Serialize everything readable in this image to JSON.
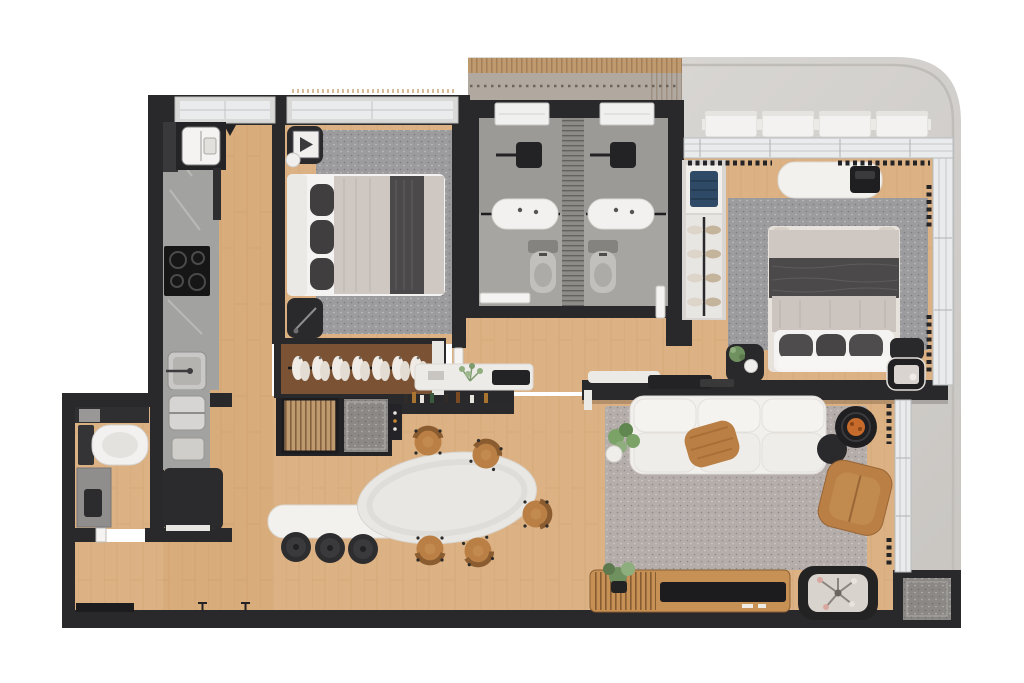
{
  "meta": {
    "kind": "apartment-floor-plan-render",
    "width": 1024,
    "height": 683,
    "visible_text": "none"
  },
  "colors": {
    "background": "#ffffff",
    "wall": "#29282a",
    "wood": "#dcb183",
    "terrace_light": "#dbd9d6",
    "terrace_dark": "#cbc8c4",
    "texture_zone": "#b1a9a0",
    "deck_band": "#c09a6f",
    "bath_floor": "#a7a5a2",
    "bath_floor_dark": "#9c9a97",
    "duct": "#8e8c89",
    "counter": "#a2a2a0",
    "counter_dark": "#39383a",
    "cooktop_black": "#161617",
    "fridge": "#2b2a2c",
    "white_furniture": "#f2f1ee",
    "off_white": "#e9e7e3",
    "rug_gray": "#9c9b9d",
    "rug_living": "#b4adaa",
    "duvet_dark": "#4b494a",
    "duvet_light": "#cfc8c2",
    "pillow_dark": "#403e3f",
    "caramel": "#b97f45",
    "caramel_dark": "#8a5c30",
    "plant_green": "#6f9160",
    "plant_green_light": "#8fae7e",
    "denim_blue": "#2e4a66",
    "mat_gray": "#8b8885",
    "glazing": "#e9ebec",
    "glazing_frame": "#b9bcbe",
    "closet_wood": "#7b5233",
    "orange_accent": "#c76b2d"
  },
  "counts": {
    "bedrooms": 2,
    "en_suite_bathrooms": 2,
    "guest_toilets": 1,
    "ac_units": 4,
    "dining_chairs": 5,
    "island_stools": 3,
    "sofa_modules": 3,
    "wardrobe_garments": 7
  },
  "rooms": {
    "kitchen": {
      "furniture": [
        "laundry-box",
        "counter",
        "cooktop",
        "kitchen-sink",
        "utility-sink",
        "refrigerator"
      ]
    },
    "bedroom_left": {
      "furniture": [
        "double-bed",
        "nightstand-art",
        "nightstand-plain",
        "area-rug",
        "open-wardrobe"
      ]
    },
    "bathroom_left": {
      "furniture": [
        "shower",
        "glass-screen",
        "vanity",
        "toilet",
        "window",
        "door"
      ]
    },
    "bathroom_right": {
      "furniture": [
        "shower",
        "glass-screen",
        "vanity",
        "toilet",
        "window",
        "door"
      ]
    },
    "bedroom_master": {
      "furniture": [
        "double-bed",
        "nightstand-plant",
        "nightstand-tray",
        "area-rug",
        "desk-bench",
        "laptop",
        "shelf-unit",
        "shoe-rack",
        "curtains"
      ]
    },
    "guest_bathroom": {
      "furniture": [
        "toilet",
        "vanity",
        "shelf",
        "door"
      ]
    },
    "entry_niche": {
      "furniture": [
        "slatted-rack",
        "doormat"
      ]
    },
    "dining": {
      "furniture": [
        "oval-table",
        "chairs",
        "island-counter",
        "island-planter",
        "stools",
        "bar-shelf",
        "console-ledge"
      ]
    },
    "living": {
      "furniture": [
        "modular-sofa",
        "throw-blanket",
        "plant",
        "nesting-tables",
        "lounge-chair",
        "media-console",
        "tv-panel",
        "flower-planter",
        "area-rug",
        "doormat"
      ]
    },
    "terrace": {
      "furniture": [
        "ac-condensers",
        "parapet"
      ]
    }
  }
}
